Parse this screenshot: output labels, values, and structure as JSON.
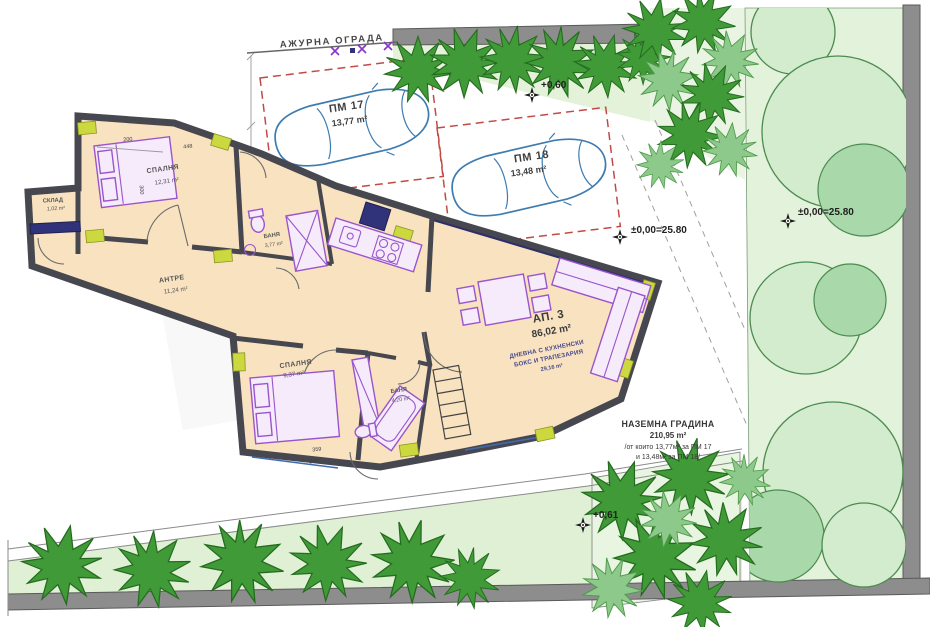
{
  "labels": {
    "fence": "АЖУРНА ОГРАДА"
  },
  "parking": {
    "pm17": {
      "id": "ПМ 17",
      "area": "13,77 m²"
    },
    "pm18": {
      "id": "ПМ 18",
      "area": "13,48 m²"
    }
  },
  "rooms": {
    "bedroom1": {
      "name": "СПАЛНЯ",
      "area": "12,31 m²"
    },
    "storage": {
      "name": "СКЛАД",
      "area": "1,02 m²"
    },
    "hall": {
      "name": "АНТРЕ",
      "area": "11,24 m²"
    },
    "bath1": {
      "name": "БАНЯ",
      "area": "3,77 m²"
    },
    "bedroom2": {
      "name": "СПАЛНЯ",
      "area": "9,37 m²"
    },
    "bath2": {
      "name": "БАНЯ",
      "area": "4,20 m²"
    }
  },
  "apartment": {
    "id": "АП. 3",
    "area": "86,02 m²",
    "living_line1": "ДНЕВНА С КУХНЕНСКИ",
    "living_line2": "БОКС И ТРАПЕЗАРИЯ",
    "living_area": "29,16 m²"
  },
  "garden": {
    "line1": "НАЗЕМНА ГРАДИНА",
    "line2": "210,95 m²",
    "line3": "/от които 13,77м² за ПМ 17",
    "line4": "и 13,48м² за ПМ 18/"
  },
  "elevations": {
    "top": "+0,60",
    "mid": "±0,00=25.80",
    "right": "±0,00=25.80",
    "bottom": "+0,61"
  },
  "dimensions": {
    "d1": "200",
    "d2": "448",
    "d3": "300",
    "d4": "359",
    "d5": "540"
  },
  "colors": {
    "room_fill": "#f8e2c0",
    "wall": "#474750",
    "furniture": "#9a55cc",
    "car_outline": "#3e7cb0",
    "parking_dash": "#c24a42",
    "bush_green": "#3f9a37",
    "canopy_green": "#d4ecce",
    "garden_bg": "#e3f2da",
    "boundary_wall": "#8d8d8d",
    "window_accent": "#ccd93e"
  }
}
